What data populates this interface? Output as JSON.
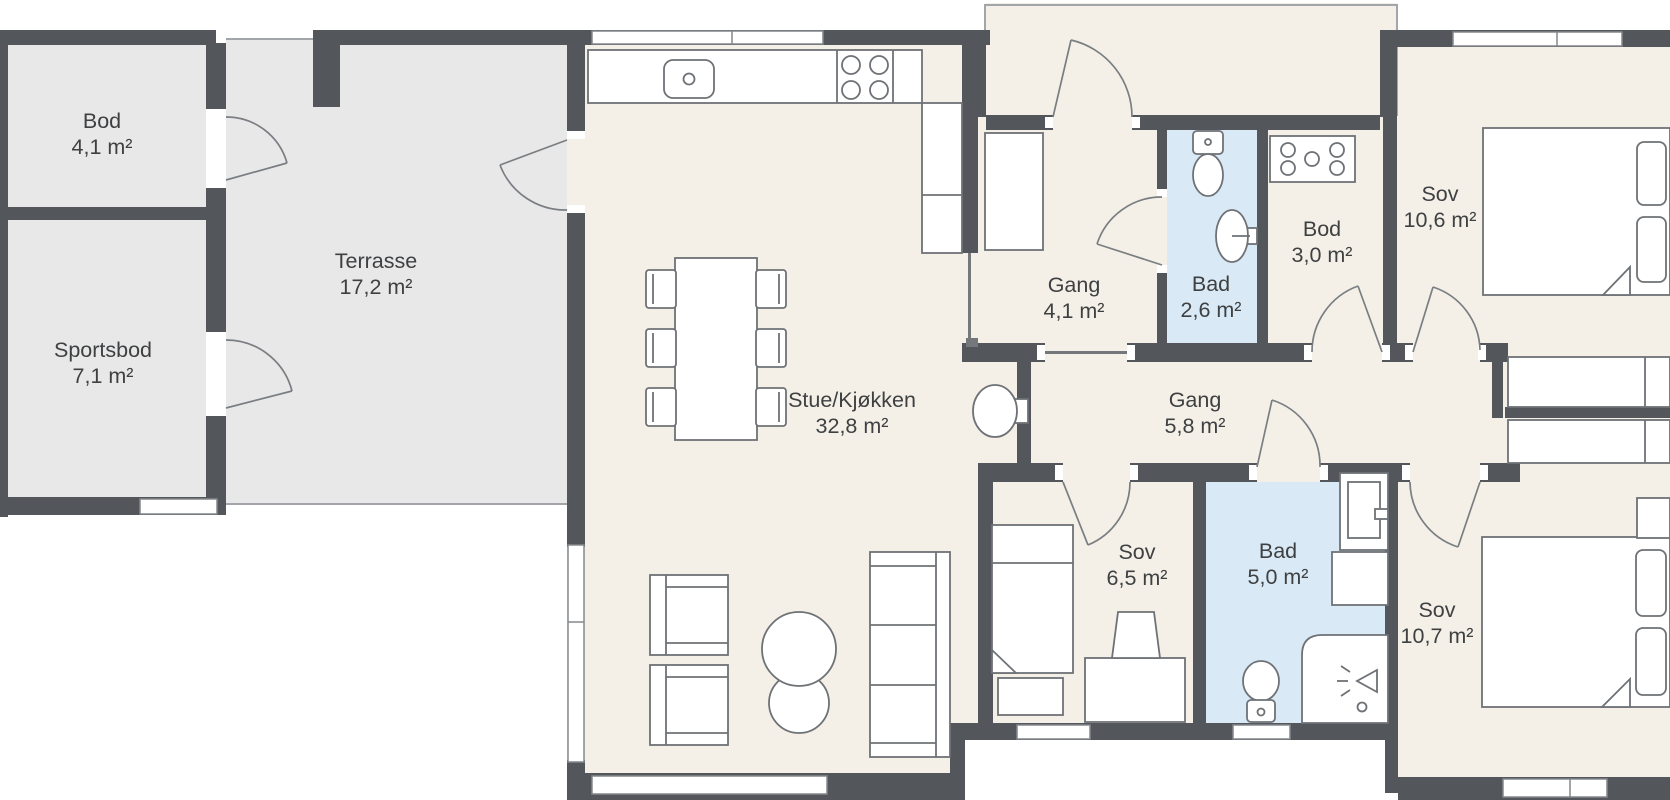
{
  "rooms": {
    "bod_storage": {
      "name": "Bod",
      "area": "4,1 m²"
    },
    "sportsbod": {
      "name": "Sportsbod",
      "area": "7,1 m²"
    },
    "terrasse": {
      "name": "Terrasse",
      "area": "17,2 m²"
    },
    "stue_kjokken": {
      "name": "Stue/Kjøkken",
      "area": "32,8 m²"
    },
    "gang_entry": {
      "name": "Gang",
      "area": "4,1 m²"
    },
    "bad_small": {
      "name": "Bad",
      "area": "2,6 m²"
    },
    "bod_indoor": {
      "name": "Bod",
      "area": "3,0 m²"
    },
    "sov_1": {
      "name": "Sov",
      "area": "10,6 m²"
    },
    "gang_inner": {
      "name": "Gang",
      "area": "5,8 m²"
    },
    "sov_2": {
      "name": "Sov",
      "area": "6,5 m²"
    },
    "bad_main": {
      "name": "Bad",
      "area": "5,0 m²"
    },
    "sov_3": {
      "name": "Sov",
      "area": "10,7 m²"
    }
  },
  "colors": {
    "wall": "#53565b",
    "floor_interior": "#f4f0e7",
    "floor_outdoor": "#e8e8e8",
    "floor_bathroom": "#d9eaf6",
    "line": "#6e7276"
  }
}
